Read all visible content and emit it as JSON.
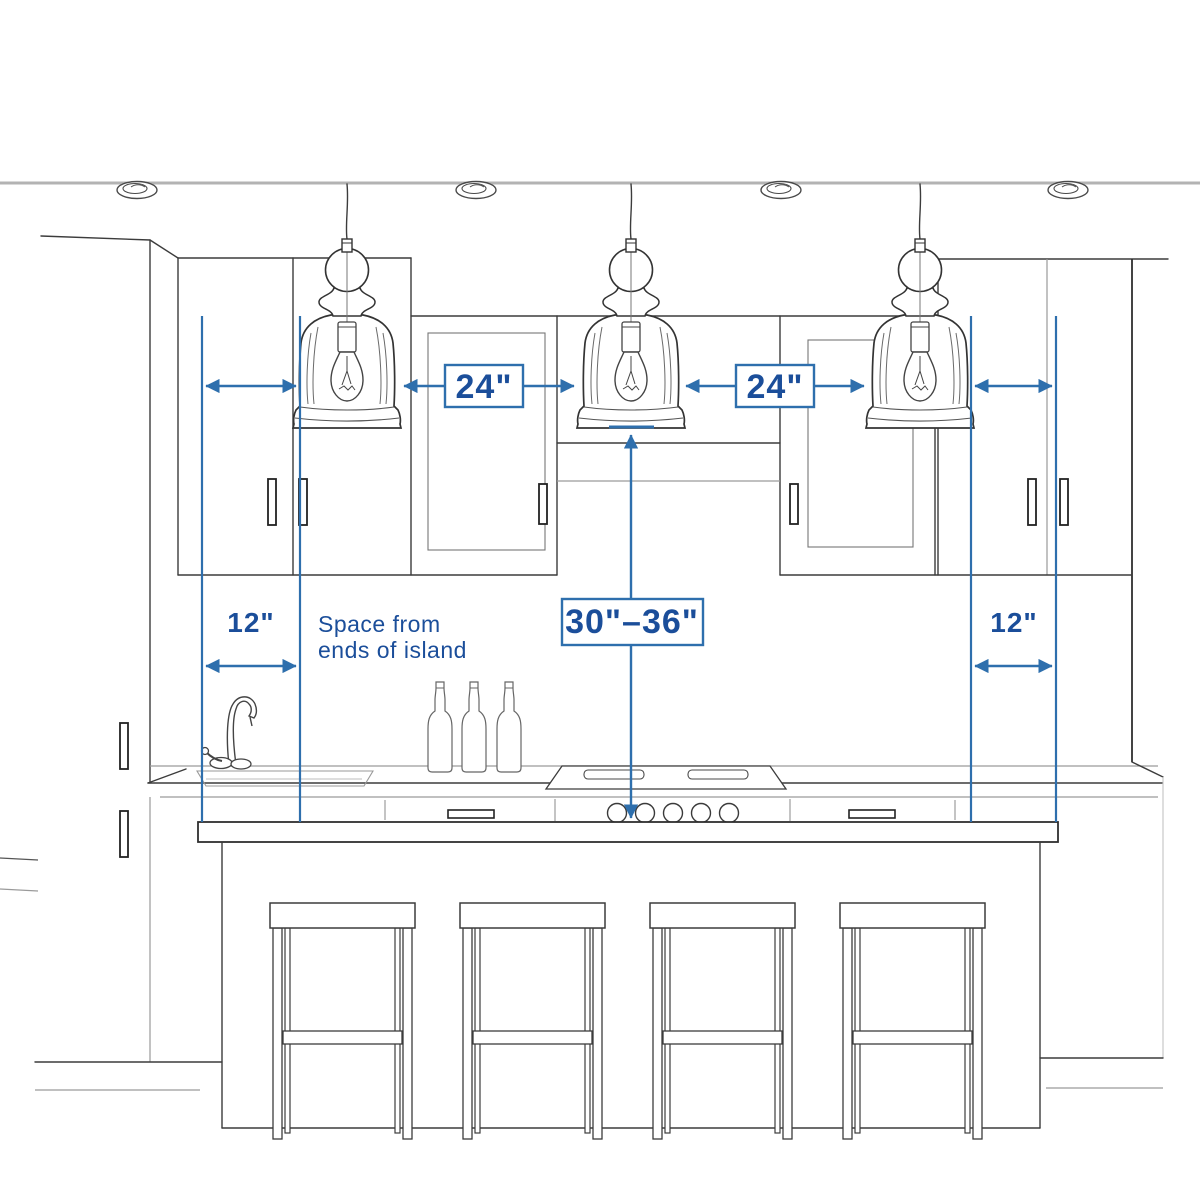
{
  "diagram": {
    "labels": {
      "pendant_spacing": "24\"",
      "end_clearance": "12\"",
      "height_above_counter": "30\"–36\"",
      "note_line1": "Space from",
      "note_line2": "ends of island"
    },
    "counts": {
      "pendants": 3,
      "bar_stools": 4,
      "recessed_ceiling_lights": 4,
      "wine_bottles": 3
    },
    "colors": {
      "dimension_blue": "#2e6fad",
      "label_text_blue": "#1b4e9a",
      "sketch_dark": "#3c3c3c",
      "sketch_light": "#9a9a9a",
      "ceiling_gray": "#b3b3b3",
      "background": "#ffffff"
    }
  }
}
